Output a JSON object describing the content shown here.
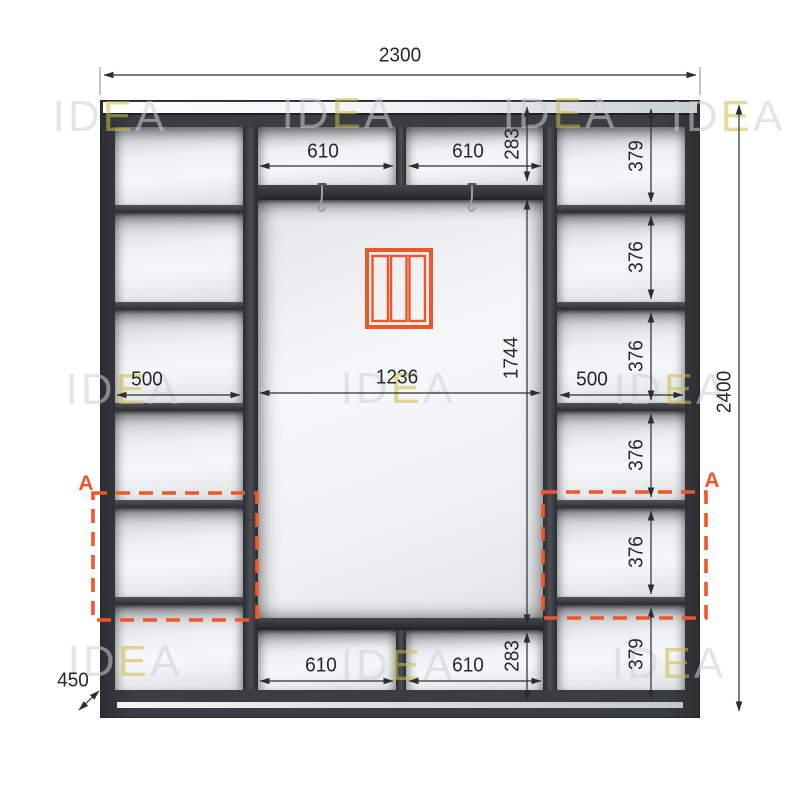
{
  "watermark": {
    "prefix": "ID",
    "accent": "E",
    "suffix": "A"
  },
  "dims": {
    "overall_width": "2300",
    "overall_height": "2400",
    "depth": "450",
    "top_left_compartment": "610",
    "top_right_compartment": "610",
    "top_section_height": "283",
    "left_column_width": "500",
    "center_width": "1236",
    "center_height": "1744",
    "right_column_width": "500",
    "bottom_left_compartment": "610",
    "bottom_right_compartment": "610",
    "bottom_section_height": "283",
    "right_shelves": [
      "379",
      "376",
      "376",
      "376",
      "376",
      "379"
    ],
    "section_label": "A"
  },
  "colors": {
    "accent_orange": "#f1562a",
    "carcass_dark": "#3a3e43",
    "watermark_gray": "#cfd1d3",
    "watermark_yellow": "#cdbd4a"
  }
}
